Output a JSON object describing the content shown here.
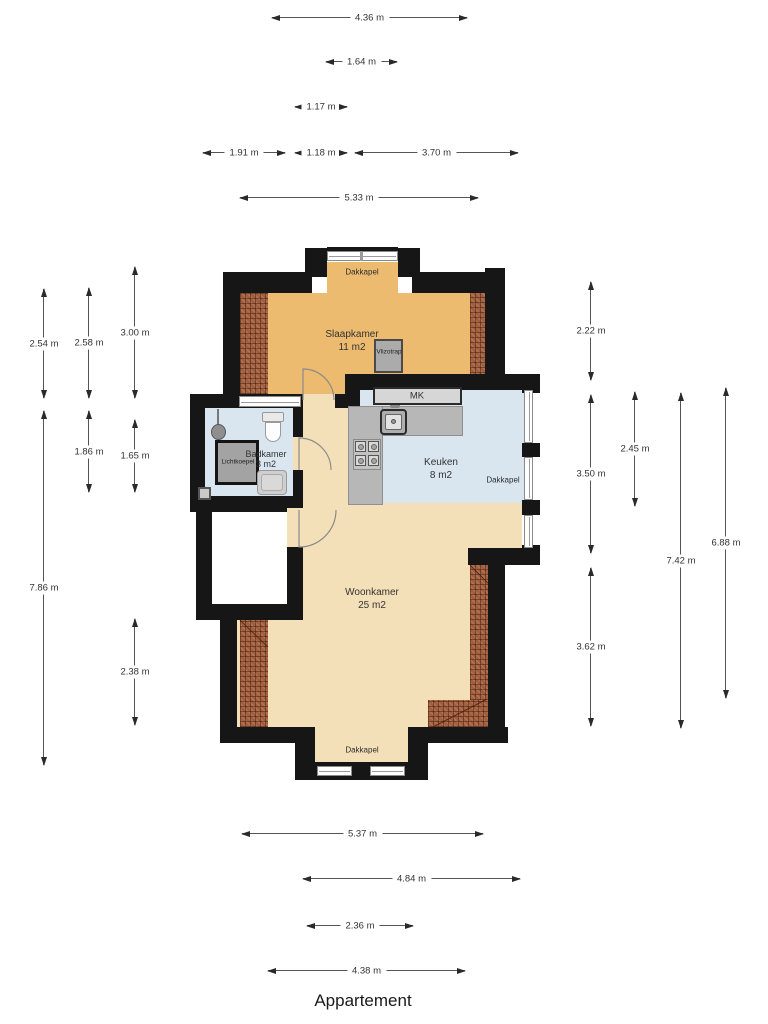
{
  "title": "Appartement",
  "colors": {
    "wall": "#161616",
    "bedroom_floor": "#ecbb70",
    "living_floor": "#f4e0b8",
    "wet_room_floor": "#d9e6f0",
    "roof_hatch": "#a2603f",
    "counter": "#b7b7b7",
    "dimension_text": "#333333"
  },
  "rooms": {
    "slaapkamer": {
      "name": "Slaapkamer",
      "area": "11 m2"
    },
    "badkamer": {
      "name": "Badkamer",
      "area": "3 m2"
    },
    "keuken": {
      "name": "Keuken",
      "area": "8 m2"
    },
    "woonkamer": {
      "name": "Woonkamer",
      "area": "25 m2"
    }
  },
  "features": {
    "dakkapel_top": "Dakkapel",
    "dakkapel_right": "Dakkapel",
    "dakkapel_bottom": "Dakkapel",
    "mk": "MK",
    "vlizotrap": "Vlizotrap",
    "lichtkoepel": "Lichtkoepel"
  },
  "dimensions": {
    "top": [
      "4.36 m",
      "1.64 m",
      "1.17 m",
      "1.91 m",
      "1.18 m",
      "3.70 m",
      "5.33 m"
    ],
    "left": [
      "2.54 m",
      "2.58 m",
      "3.00 m",
      "1.86 m",
      "1.65 m",
      "7.86 m",
      "2.38 m"
    ],
    "right": [
      "2.22 m",
      "3.50 m",
      "2.45 m",
      "7.42 m",
      "6.88 m",
      "3.62 m"
    ],
    "bottom": [
      "5.37 m",
      "4.84 m",
      "2.36 m",
      "4.38 m"
    ]
  }
}
